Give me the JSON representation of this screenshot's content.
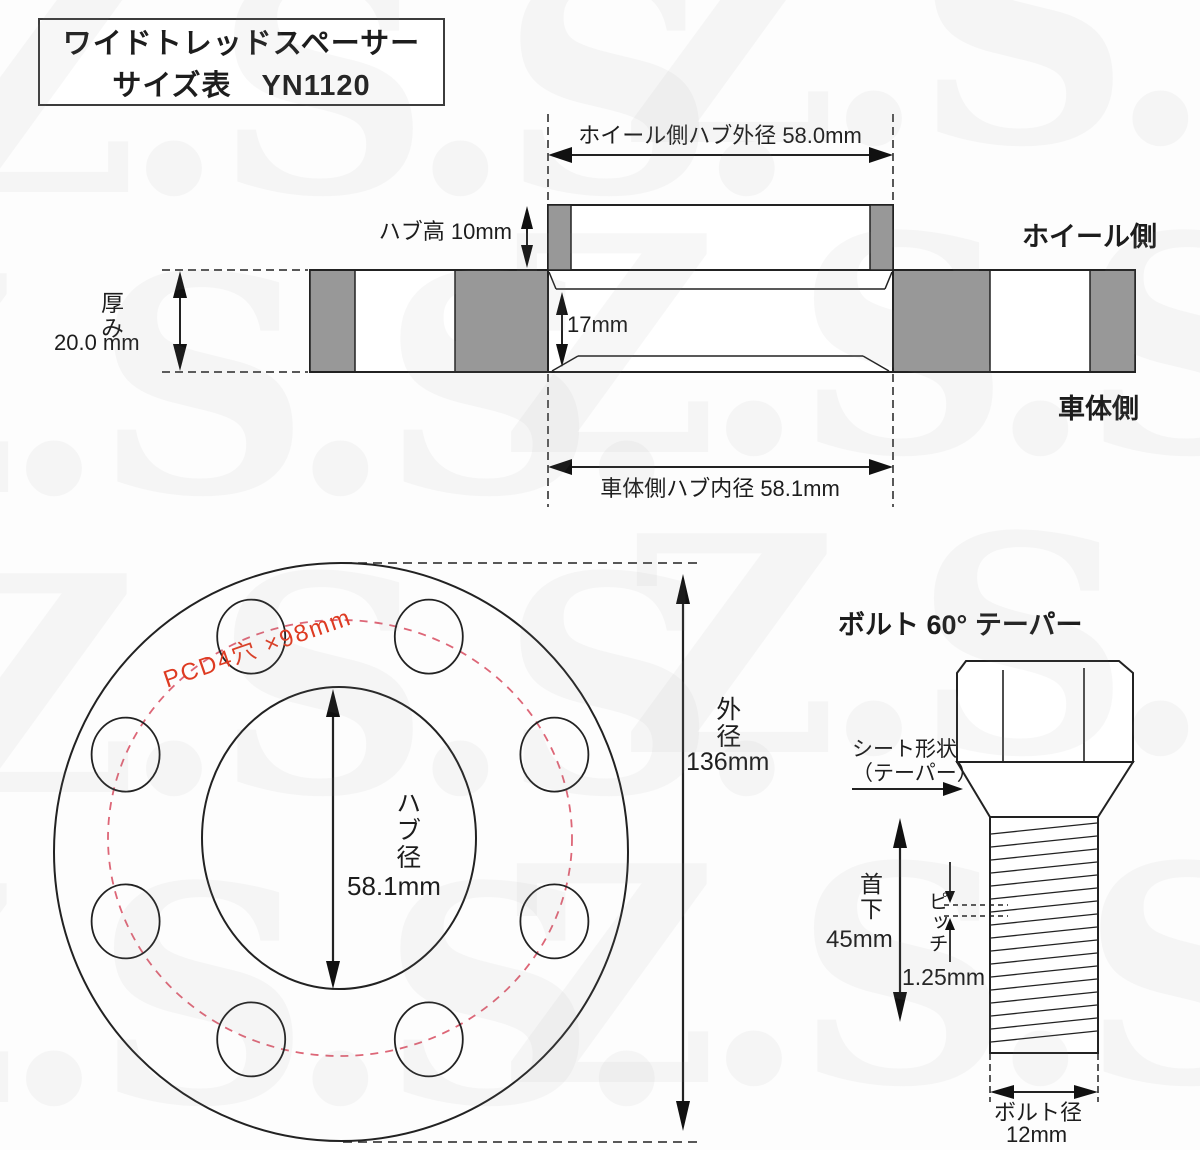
{
  "title": {
    "line1": "ワイドトレッドスペーサー",
    "line2": "サイズ表　YN1120"
  },
  "cross_section": {
    "dim_outer": "ホイール側ハブ外径 58.0mm",
    "hub_height": "ハブ高 10mm",
    "thickness_label": "厚み",
    "thickness_value": "20.0 mm",
    "bore_depth": "17mm",
    "dim_inner": "車体側ハブ内径  58.1mm",
    "wheel_side": "ホイール側",
    "body_side": "車体側"
  },
  "front_view": {
    "pcd_label": "PCD4穴 ×98mm",
    "hub_dia_label": "ハブ径",
    "hub_dia_value": "58.1mm",
    "outer_dia_label": "外径",
    "outer_dia_value": "136mm",
    "bolt_hole_count": 8
  },
  "bolt": {
    "title": "ボルト  60° テーパー",
    "seat_label": "シート形状\n（テーパー）",
    "neck_label": "首下",
    "neck_value": "45mm",
    "pitch_label": "ピッチ",
    "pitch_value": "1.25mm",
    "dia_label": "ボルト径",
    "dia_value": "12mm"
  },
  "watermark": {
    "text": "Z.S.S."
  },
  "colors": {
    "line": "#222222",
    "gray_fill": "#989898",
    "red_text": "#de3b22",
    "pcd_dash": "#dd6677"
  }
}
